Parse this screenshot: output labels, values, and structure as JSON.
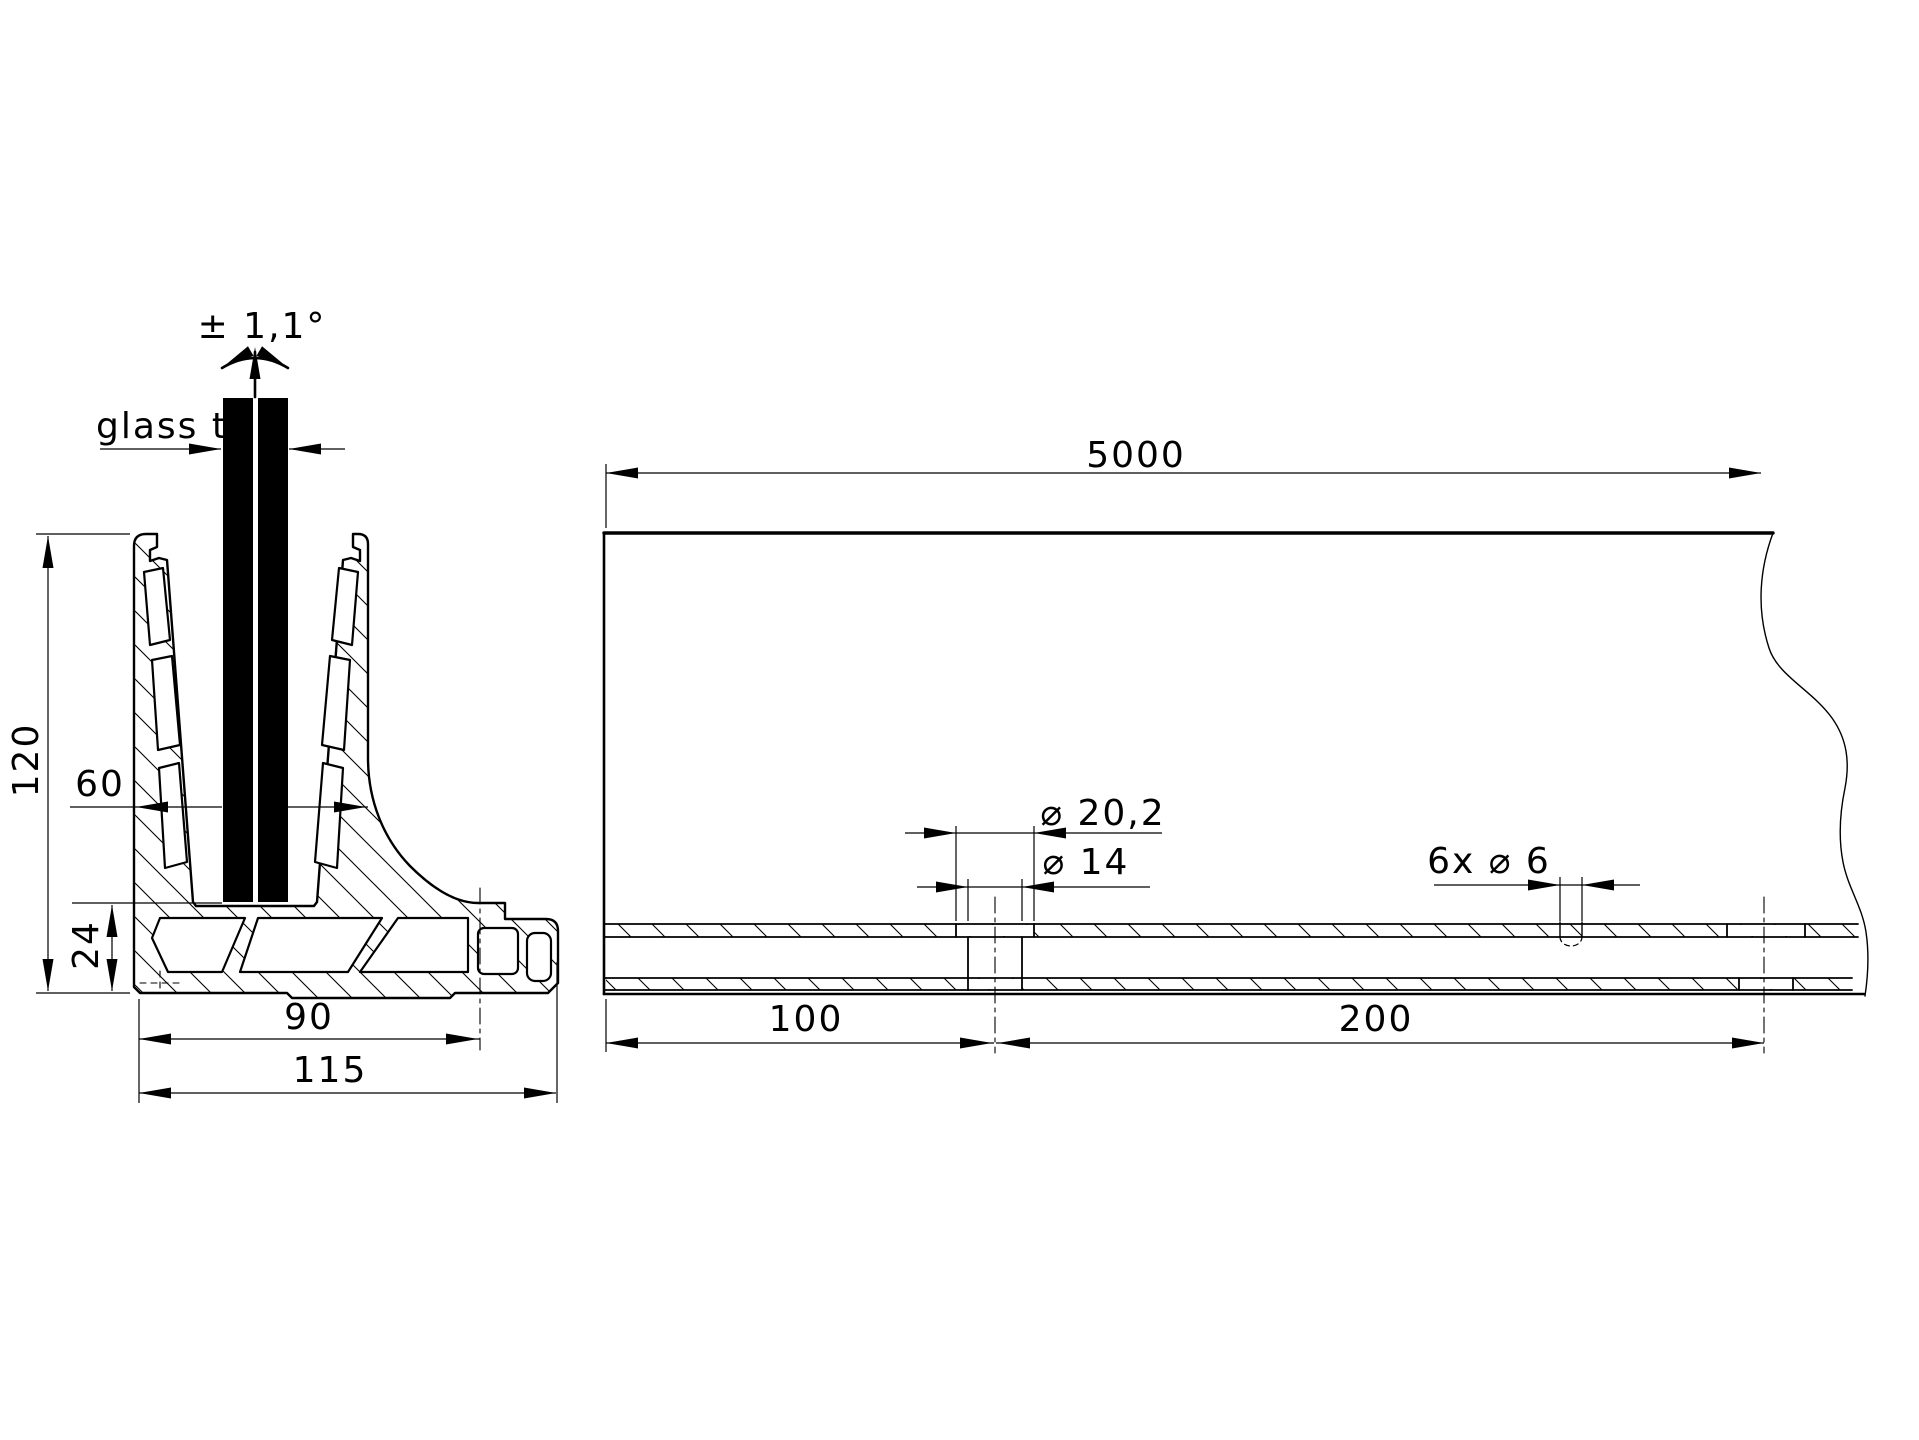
{
  "cross_section": {
    "labels": {
      "angle_tolerance": "± 1,1°",
      "glass_thickness": "glass t",
      "height": "120",
      "top_width": "60",
      "base_height": "24",
      "hole_offset": "90",
      "base_width": "115"
    }
  },
  "side_view": {
    "labels": {
      "length": "5000",
      "counterbore_diameter": "⌀ 20,2",
      "hole_diameter": "⌀ 14",
      "drain_holes": "6x ⌀ 6",
      "end_to_first_hole": "100",
      "hole_spacing": "200"
    }
  },
  "colors": {
    "line": "#000000",
    "background": "#ffffff",
    "glass": "#000000"
  }
}
